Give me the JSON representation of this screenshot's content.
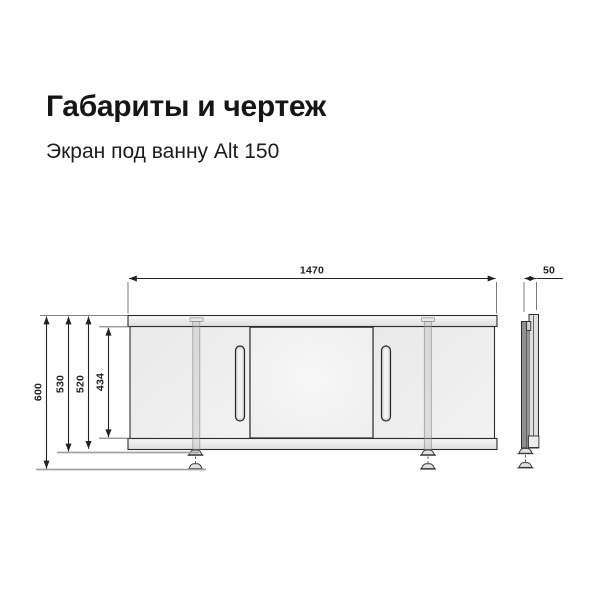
{
  "header": {
    "title": "Габариты и чертеж",
    "subtitle": "Экран под ванну Alt 150"
  },
  "drawing": {
    "dimensions": {
      "width": "1470",
      "depth": "50",
      "height_overall": "600",
      "height_with_feet": "530",
      "height_panel": "520",
      "height_opening": "434"
    }
  },
  "colors": {
    "background": "#ffffff",
    "title_text": "#161616",
    "outline": "#2d2d2d",
    "dimension": "#222222",
    "panel_fill": "#ededed",
    "front_door_fill": "#f4f4f4",
    "rail_fill": "#e7e7e7",
    "helper_line": "#a3a3a3"
  }
}
